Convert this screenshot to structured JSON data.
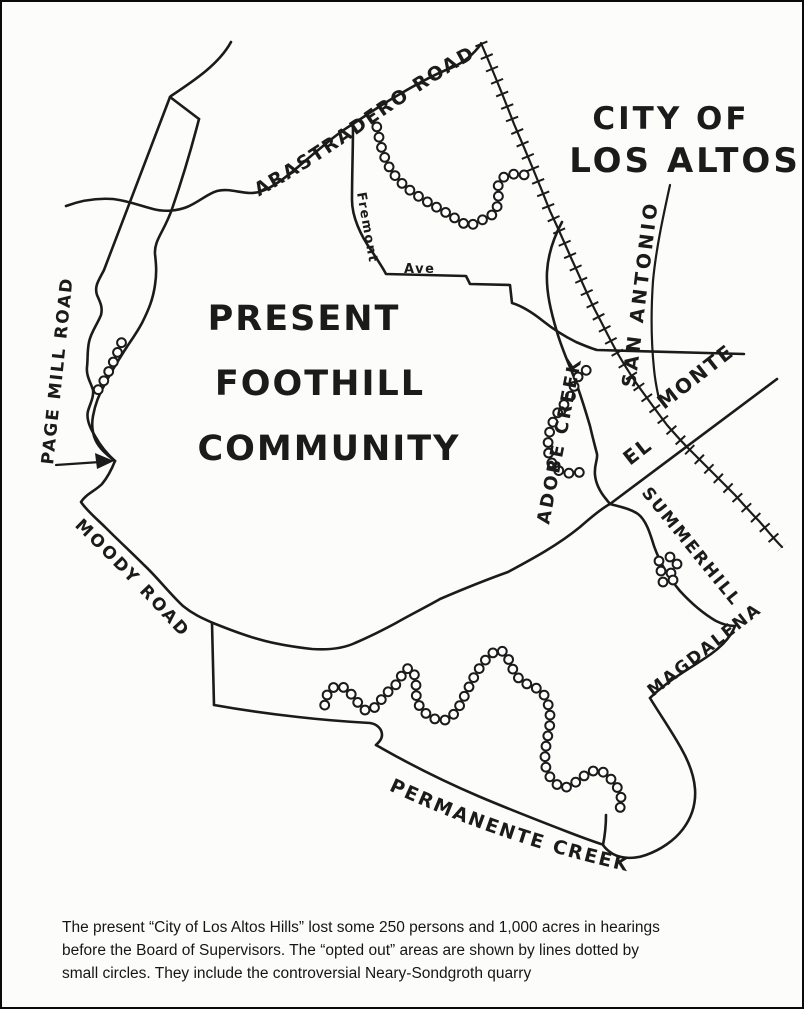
{
  "map": {
    "labels": {
      "arastradero": "ARASTRADERO ROAD",
      "city_line1": "CITY OF",
      "city_line2": "LOS ALTOS",
      "title1": "PRESENT",
      "title2": "FOOTHILL",
      "title3": "COMMUNITY",
      "page_mill": "PAGE MILL ROAD",
      "fremont": "Fremont",
      "ave": "Ave",
      "san_antonio": "SAN ANTONIO",
      "adobe_creek": "ADOBE CREEK",
      "el": "EL",
      "monte": "MONTE",
      "summerhill": "SUMMERHILL",
      "magdalena": "MAGDALENA",
      "moody": "MOODY ROAD",
      "permanente": "PERMANENTE CREEK"
    },
    "legend_note": "opted out areas shown by lines dotted by small circles"
  },
  "caption": {
    "line1": "The present “City of Los Altos Hills” lost some 250 persons and 1,000 acres in hearings",
    "line2": "before the Board of Supervisors. The “opted out” areas are shown by lines dotted by",
    "line3": "small circles. They include the controversial Neary-Sondgroth quarry"
  },
  "colors": {
    "ink": "#1b1b1b",
    "paper": "#fcfcfb"
  }
}
